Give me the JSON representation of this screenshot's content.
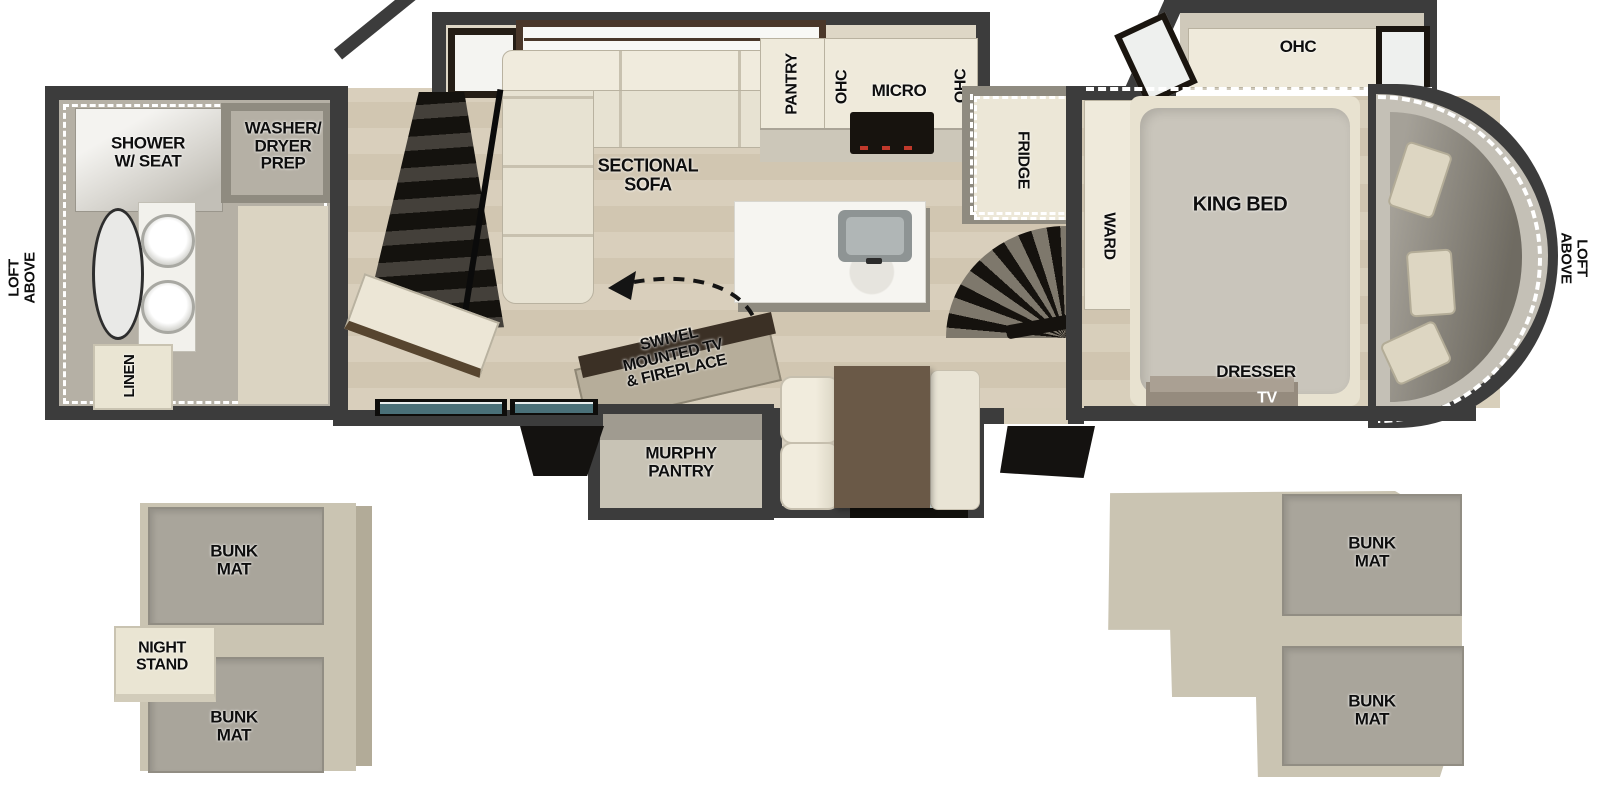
{
  "plan": {
    "title": "RV fifth-wheel floor plan with loft",
    "colors": {
      "wall": "#3c3c3c",
      "wood_floor": "#d9cfbc",
      "bath_floor": "#b5b0a5",
      "cabinet_cream": "#efeadb",
      "bunk_mat_gray": "#a9a59b",
      "loft_platform_tan": "#cac4b2",
      "stairs_black": "#15120e",
      "dash_white": "#ffffff",
      "table_brown": "#6a5947",
      "stove_red": "#c0392b"
    },
    "bathroom": {
      "shower_label": "SHOWER\nW/ SEAT",
      "washer_dryer_label": "WASHER/\nDRYER\nPREP",
      "linen_label": "LINEN"
    },
    "living_kitchen": {
      "sofa_label": "SECTIONAL\nSOFA",
      "swivel_label": "SWIVEL\nMOUNTED TV\n& FIREPLACE",
      "murphy_label": "MURPHY\nPANTRY",
      "pantry_label": "PANTRY",
      "ohc_left_label": "OHC",
      "micro_label": "MICRO",
      "ohc_right_label": "OHC",
      "fridge_label": "FRIDGE"
    },
    "bedroom": {
      "ward_label": "WARD",
      "king_bed_label": "KING BED",
      "ohc_label": "OHC",
      "dresser_label": "DRESSER",
      "tv_label": "TV"
    },
    "loft_markers": {
      "left": "LOFT\nABOVE",
      "right": "LOFT\nABOVE"
    },
    "rear_loft": {
      "bunk_top_label": "BUNK\nMAT",
      "night_stand_label": "NIGHT\nSTAND",
      "bunk_bottom_label": "BUNK\nMAT"
    },
    "front_loft": {
      "bunk_top_label": "BUNK\nMAT",
      "bunk_bottom_label": "BUNK\nMAT"
    }
  }
}
